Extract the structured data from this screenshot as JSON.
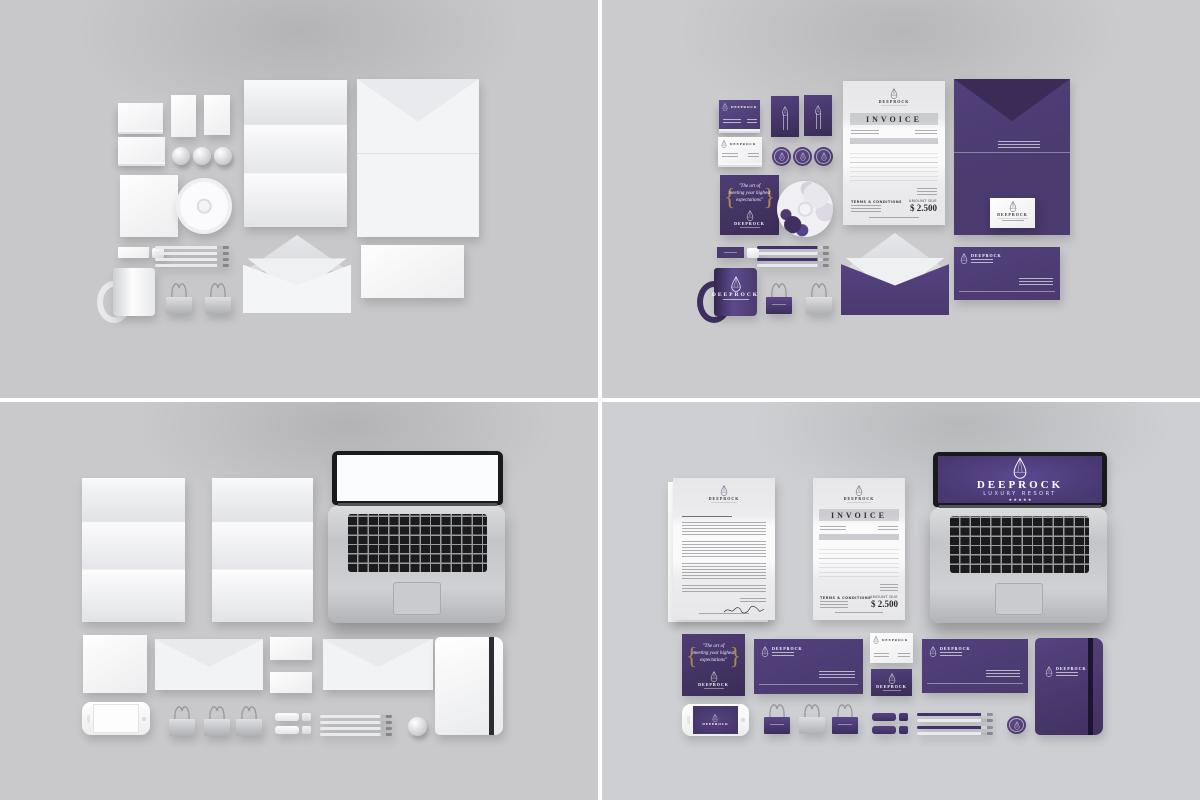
{
  "brand": {
    "name": "DEEPROCK",
    "subtitle": "LUXURY RESORT",
    "stars": "★ ★ ★ ★ ★",
    "tagline_open_brace": "{",
    "tagline_close_brace": "}",
    "tagline_line1": "\"The art of",
    "tagline_line2": "meeting your highest",
    "tagline_line3": "expectations\"",
    "purple": "#4a3a6d",
    "purple_dark": "#3a2c56",
    "purple_light": "#5b4a8a",
    "gold": "#a8894e"
  },
  "invoice": {
    "title": "INVOICE",
    "terms_label": "TERMS & CONDITIONS",
    "amount_due_label": "AMOUNT DUE",
    "total": "$ 2.500"
  },
  "quadrants": {
    "top_left": {
      "background": "#c8c8cb"
    },
    "top_right": {
      "background": "#cbcbce"
    },
    "bottom_left": {
      "background": "#c9c9cc"
    },
    "bottom_right": {
      "background": "#cecfd2"
    }
  }
}
